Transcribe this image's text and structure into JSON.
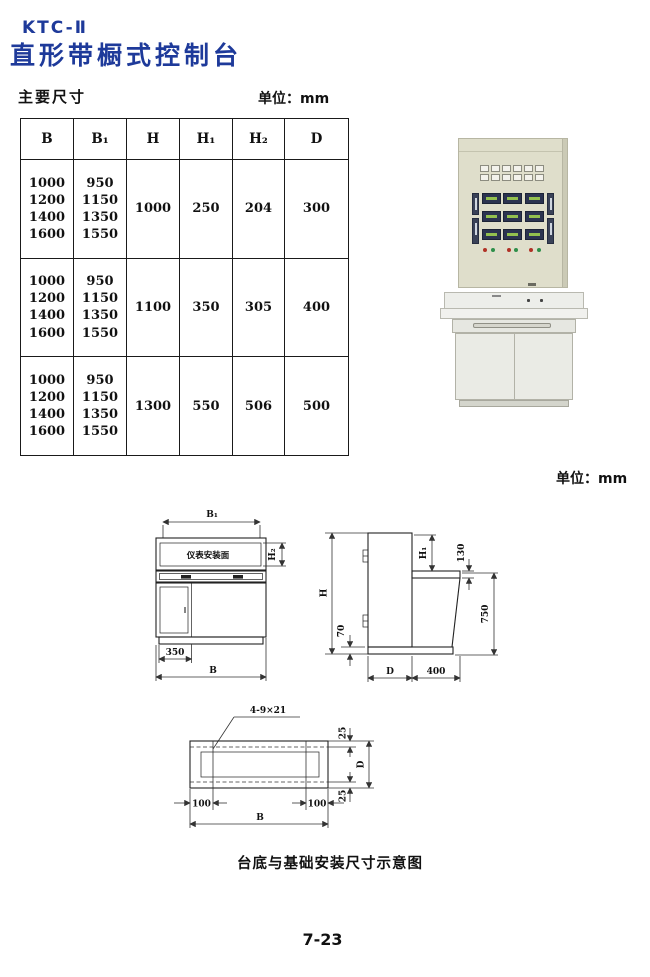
{
  "page": {
    "model": "KTC-Ⅱ",
    "title": "直形带橱式控制台",
    "section_label": "主要尺寸",
    "unit_top": "单位：mm",
    "unit_mid": "单位：mm",
    "caption": "台底与基础安装尺寸示意图",
    "page_number": "7-23"
  },
  "colors": {
    "title_blue": "#1e3a9a",
    "line_dark": "#222222",
    "panel_beige": "#dfdecb",
    "cabinet_gray": "#eaebe5",
    "indicator_red": "#b13226",
    "indicator_green": "#2e8f4a"
  },
  "table": {
    "headers": [
      "B",
      "B₁",
      "H",
      "H₁",
      "H₂",
      "D"
    ],
    "row_groups": [
      {
        "b": "1000\n1200\n1400\n1600",
        "b1": "950\n1150\n1350\n1550",
        "h": "1000",
        "h1": "250",
        "h2": "204",
        "d": "300"
      },
      {
        "b": "1000\n1200\n1400\n1600",
        "b1": "950\n1150\n1350\n1550",
        "h": "1100",
        "h1": "350",
        "h2": "305",
        "d": "400"
      },
      {
        "b": "1000\n1200\n1400\n1600",
        "b1": "950\n1150\n1350\n1550",
        "h": "1300",
        "h1": "550",
        "h2": "506",
        "d": "500"
      }
    ]
  },
  "front_view": {
    "dim_b1": "B₁",
    "panel_label": "仪表安装面",
    "dim_h2": "H₂",
    "dim_350": "350",
    "dim_b": "B"
  },
  "side_view": {
    "dim_h": "H",
    "dim_h1": "H₁",
    "dim_130": "130",
    "dim_750": "750",
    "dim_70": "70",
    "dim_d": "D",
    "dim_400": "400"
  },
  "base_view": {
    "slot_label": "4-9×21",
    "dim_25_top": "25",
    "dim_d": "D",
    "dim_25_bottom": "25",
    "dim_100_left": "100",
    "dim_100_right": "100",
    "dim_b": "B"
  }
}
